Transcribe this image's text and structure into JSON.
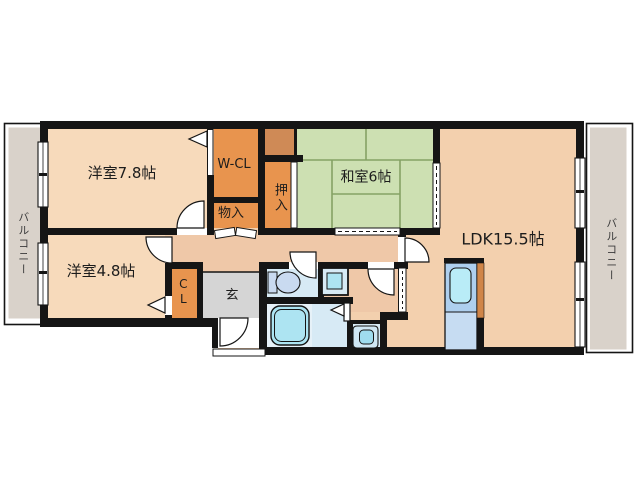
{
  "plan": {
    "type": "apartment-floor-plan",
    "rooms": {
      "bedroom1": "洋室7.8帖",
      "bedroom2": "洋室4.8帖",
      "tatami_room": "和室6帖",
      "ldk": "LDK15.5帖",
      "walk_in_closet": "W-CL",
      "storage": "物入",
      "oshiire": "押入",
      "closet": "CL",
      "entrance": "玄",
      "balcony_left": "バルコニー",
      "balcony_right": "バルコニー"
    },
    "colors": {
      "wall": "#151515",
      "bedroom_floor": "#f7dabb",
      "ldk_floor": "#f3d0ae",
      "hall_floor": "#efc8a8",
      "tatami": "#cde0b2",
      "closet_fill": "#e8944e",
      "upper_shelf_fill": "#cf8a56",
      "genkan_gray": "#d5d5d5",
      "wet_area_floor": "#d7eaf5",
      "fixture_blue": "#ade4f2",
      "kitchen_counter": "#aecfee",
      "balcony_gray": "#d9d2ca"
    }
  }
}
